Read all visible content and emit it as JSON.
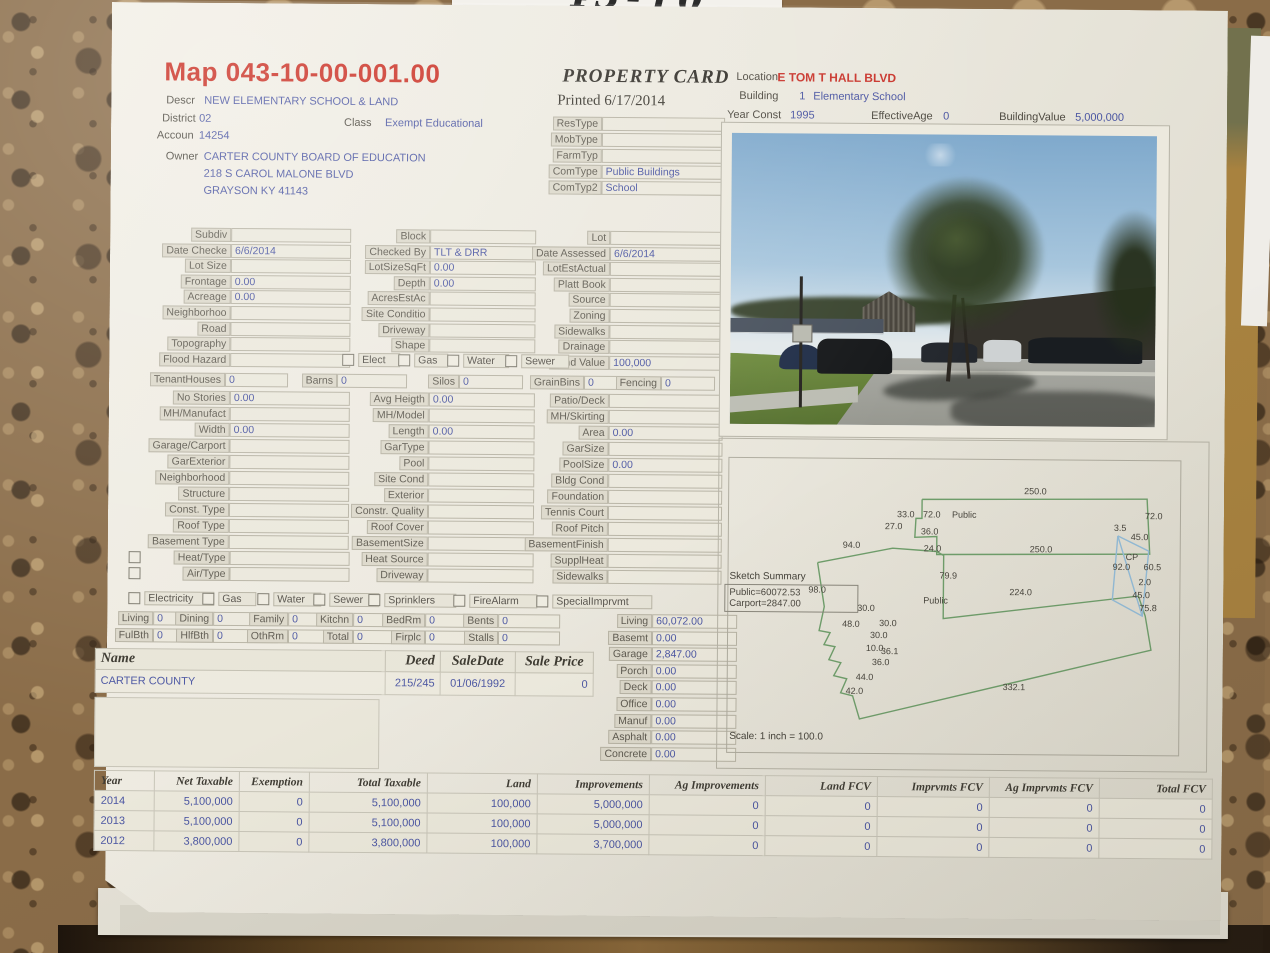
{
  "note": {
    "handwriting": "43-10"
  },
  "header": {
    "map_number": "Map 043-10-00-001.00",
    "card_title": "PROPERTY CARD",
    "printed": "Printed 6/17/2014",
    "descr_label": "Descr",
    "descr": "NEW ELEMENTARY SCHOOL & LAND",
    "district_label": "District",
    "district": "02",
    "class_label": "Class",
    "class_value": "Exempt Educational",
    "accoun_label": "Accoun",
    "accoun": "14254",
    "owner_label": "Owner",
    "owner": "CARTER COUNTY BOARD OF EDUCATION",
    "owner_addr1": "218 S CAROL MALONE BLVD",
    "owner_addr2": "GRAYSON KY 41143",
    "location_label": "Location",
    "location": "E TOM T HALL BLVD",
    "building_label": "Building",
    "building_num": "1",
    "building_name": "Elementary School",
    "year_const_label": "Year Const",
    "year_const": "1995",
    "effective_age_label": "EffectiveAge",
    "effective_age": "0",
    "building_value_label": "BuildingValue",
    "building_value": "5,000,000"
  },
  "type_table": [
    {
      "label": "ResType",
      "value": ""
    },
    {
      "label": "MobType",
      "value": ""
    },
    {
      "label": "FarmTyp",
      "value": ""
    },
    {
      "label": "ComType",
      "value": "Public Buildings"
    },
    {
      "label": "ComTyp2",
      "value": "School"
    }
  ],
  "grid": {
    "colA1": [
      {
        "label": "Subdiv",
        "value": ""
      },
      {
        "label": "Date Checke",
        "value": "6/6/2014"
      },
      {
        "label": "Lot Size",
        "value": ""
      },
      {
        "label": "Frontage",
        "value": "0.00"
      },
      {
        "label": "Acreage",
        "value": "0.00"
      },
      {
        "label": "Neighborhoo",
        "value": ""
      },
      {
        "label": "Road",
        "value": ""
      },
      {
        "label": "Topography",
        "value": ""
      },
      {
        "label": "Flood Hazard",
        "value": ""
      }
    ],
    "colB1": [
      {
        "label": "Block",
        "value": ""
      },
      {
        "label": "Checked By",
        "value": "TLT & DRR"
      },
      {
        "label": "LotSizeSqFt",
        "value": "0.00"
      },
      {
        "label": "Depth",
        "value": "0.00"
      },
      {
        "label": "AcresEstAc",
        "value": ""
      },
      {
        "label": "Site Conditio",
        "value": ""
      },
      {
        "label": "Driveway",
        "value": ""
      },
      {
        "label": "Shape",
        "value": ""
      }
    ],
    "colC1": [
      {
        "label": "Lot",
        "value": ""
      },
      {
        "label": "Date Assessed",
        "value": "6/6/2014"
      },
      {
        "label": "LotEstActual",
        "value": ""
      },
      {
        "label": "Platt Book",
        "value": ""
      },
      {
        "label": "Source",
        "value": ""
      },
      {
        "label": "Zoning",
        "value": ""
      },
      {
        "label": "Sidewalks",
        "value": ""
      },
      {
        "label": "Drainage",
        "value": ""
      },
      {
        "label": "Land Value",
        "value": "100,000"
      }
    ],
    "utilities_inline": [
      "Elect",
      "Gas",
      "Water",
      "Sewer"
    ],
    "farm_row": [
      {
        "label": "TenantHouses",
        "value": "0"
      },
      {
        "label": "Barns",
        "value": "0"
      },
      {
        "label": "Silos",
        "value": "0"
      },
      {
        "label": "GrainBins",
        "value": "0"
      },
      {
        "label": "Fencing",
        "value": "0"
      }
    ],
    "colA2": [
      {
        "label": "No Stories",
        "value": "0.00"
      },
      {
        "label": "MH/Manufact",
        "value": ""
      },
      {
        "label": "Width",
        "value": "0.00"
      },
      {
        "label": "Garage/Carport",
        "value": ""
      },
      {
        "label": "GarExterior",
        "value": ""
      },
      {
        "label": "Neighborhood",
        "value": ""
      },
      {
        "label": "Structure",
        "value": ""
      },
      {
        "label": "Const. Type",
        "value": ""
      },
      {
        "label": "Roof Type",
        "value": ""
      },
      {
        "label": "Basement Type",
        "value": ""
      },
      {
        "label": "Heat/Type",
        "value": "",
        "cb": true
      },
      {
        "label": "Air/Type",
        "value": "",
        "cb": true
      }
    ],
    "colB2": [
      {
        "label": "Avg Heigth",
        "value": "0.00"
      },
      {
        "label": "MH/Model",
        "value": ""
      },
      {
        "label": "Length",
        "value": "0.00"
      },
      {
        "label": "GarType",
        "value": ""
      },
      {
        "label": "Pool",
        "value": ""
      },
      {
        "label": "Site Cond",
        "value": ""
      },
      {
        "label": "Exterior",
        "value": ""
      },
      {
        "label": "Constr. Quality",
        "value": ""
      },
      {
        "label": "Roof Cover",
        "value": ""
      },
      {
        "label": "BasementSize",
        "value": ""
      },
      {
        "label": "Heat Source",
        "value": ""
      },
      {
        "label": "Driveway",
        "value": ""
      }
    ],
    "colC2": [
      {
        "label": "Patio/Deck",
        "value": ""
      },
      {
        "label": "MH/Skirting",
        "value": ""
      },
      {
        "label": "Area",
        "value": "0.00"
      },
      {
        "label": "GarSize",
        "value": ""
      },
      {
        "label": "PoolSize",
        "value": "0.00"
      },
      {
        "label": "Bldg Cond",
        "value": ""
      },
      {
        "label": "Foundation",
        "value": ""
      },
      {
        "label": "Tennis Court",
        "value": ""
      },
      {
        "label": "Roof Pitch",
        "value": ""
      },
      {
        "label": "BasementFinish",
        "value": ""
      },
      {
        "label": "SupplHeat",
        "value": ""
      },
      {
        "label": "Sidewalks",
        "value": ""
      }
    ],
    "services_row": [
      "Electricity",
      "Gas",
      "Water",
      "Sewer",
      "Sprinklers",
      "FireAlarm",
      "SpecialImprvmt"
    ],
    "rooms_row1": [
      {
        "label": "Living",
        "value": "0"
      },
      {
        "label": "Dining",
        "value": "0"
      },
      {
        "label": "Family",
        "value": "0"
      },
      {
        "label": "Kitchn",
        "value": "0"
      },
      {
        "label": "BedRm",
        "value": "0"
      },
      {
        "label": "Bents",
        "value": "0"
      }
    ],
    "rooms_row2": [
      {
        "label": "FulBth",
        "value": "0"
      },
      {
        "label": "HlfBth",
        "value": "0"
      },
      {
        "label": "OthRm",
        "value": "0"
      },
      {
        "label": "Total",
        "value": "0"
      },
      {
        "label": "Firplc",
        "value": "0"
      },
      {
        "label": "Stalls",
        "value": "0"
      }
    ]
  },
  "areas": [
    {
      "label": "Living",
      "value": "60,072.00"
    },
    {
      "label": "Basemt",
      "value": "0.00"
    },
    {
      "label": "Garage",
      "value": "2,847.00"
    },
    {
      "label": "Porch",
      "value": "0.00"
    },
    {
      "label": "Deck",
      "value": "0.00"
    },
    {
      "label": "Office",
      "value": "0.00"
    },
    {
      "label": "Manuf",
      "value": "0.00"
    },
    {
      "label": "Asphalt",
      "value": "0.00"
    },
    {
      "label": "Concrete",
      "value": "0.00"
    }
  ],
  "sales": {
    "headers": [
      "Name",
      "Deed",
      "SaleDate",
      "Sale Price"
    ],
    "rows": [
      [
        "CARTER COUNTY",
        "215/245",
        "01/06/1992",
        "0"
      ]
    ]
  },
  "sketch": {
    "summary_title": "Sketch Summary",
    "summary_lines": [
      "Public=60072.53",
      "Carport=2847.00"
    ],
    "scale": "Scale: 1 inch = 100.0",
    "shapes": [
      {
        "name": "building-outline-upper",
        "stroke": "#6f9e6b",
        "points": "926,493 1151,491 1154,546 941,548 941,530 919,531 920,512 926,512 926,493"
      },
      {
        "name": "building-outline-lower",
        "stroke": "#6f9e6b",
        "points": "822,557 897,542 941,545 948,549 948,612 1143,588 1150,608 1156,642 865,713 858,690 846,687 852,673 839,670 846,657 834,654 840,641 829,639 835,627 824,625 829,601 822,557"
      },
      {
        "name": "carport-outline",
        "stroke": "#93bcd8",
        "points": "1122,528 1153,543 1147,608 1117,592 1122,528"
      },
      {
        "name": "carport-diagonal",
        "stroke": "#93bcd8",
        "points": "1122,528 1147,608"
      }
    ],
    "labels": [
      {
        "text": "250.0",
        "x": 1028,
        "y": 479
      },
      {
        "text": "33.0",
        "x": 901,
        "y": 503
      },
      {
        "text": "72.0",
        "x": 927,
        "y": 503
      },
      {
        "text": "Public",
        "x": 956,
        "y": 503
      },
      {
        "text": "72.0",
        "x": 1149,
        "y": 503
      },
      {
        "text": "27.0",
        "x": 889,
        "y": 515
      },
      {
        "text": "36.0",
        "x": 925,
        "y": 520
      },
      {
        "text": "3.5",
        "x": 1118,
        "y": 515
      },
      {
        "text": "45.0",
        "x": 1135,
        "y": 524
      },
      {
        "text": "94.0",
        "x": 847,
        "y": 534
      },
      {
        "text": "24.0",
        "x": 928,
        "y": 537
      },
      {
        "text": "250.0",
        "x": 1034,
        "y": 537
      },
      {
        "text": "CP",
        "x": 1130,
        "y": 544
      },
      {
        "text": "92.0",
        "x": 1117,
        "y": 554
      },
      {
        "text": "60.5",
        "x": 1148,
        "y": 554
      },
      {
        "text": "79.9",
        "x": 944,
        "y": 564
      },
      {
        "text": "2.0",
        "x": 1143,
        "y": 569
      },
      {
        "text": "98.0",
        "x": 813,
        "y": 579
      },
      {
        "text": "224.0",
        "x": 1014,
        "y": 580
      },
      {
        "text": "45.0",
        "x": 1137,
        "y": 582
      },
      {
        "text": "Public",
        "x": 928,
        "y": 589
      },
      {
        "text": "30.0",
        "x": 862,
        "y": 597
      },
      {
        "text": "75.8",
        "x": 1144,
        "y": 595
      },
      {
        "text": "48.0",
        "x": 847,
        "y": 613
      },
      {
        "text": "30.0",
        "x": 884,
        "y": 612
      },
      {
        "text": "30.0",
        "x": 875,
        "y": 624
      },
      {
        "text": "10.0",
        "x": 871,
        "y": 637
      },
      {
        "text": "36.1",
        "x": 886,
        "y": 640
      },
      {
        "text": "36.0",
        "x": 877,
        "y": 651
      },
      {
        "text": "44.0",
        "x": 861,
        "y": 666
      },
      {
        "text": "42.0",
        "x": 851,
        "y": 680
      },
      {
        "text": "332.1",
        "x": 1008,
        "y": 675
      }
    ]
  },
  "assessment": {
    "headers": [
      "Year",
      "Net Taxable",
      "Exemption",
      "Total Taxable",
      "Land",
      "Improvements",
      "Ag Improvements",
      "Land FCV",
      "Imprvmts FCV",
      "Ag Imprvmts FCV",
      "Total FCV"
    ],
    "rows": [
      [
        "2014",
        "5,100,000",
        "0",
        "5,100,000",
        "100,000",
        "5,000,000",
        "0",
        "0",
        "0",
        "0",
        "0"
      ],
      [
        "2013",
        "5,100,000",
        "0",
        "5,100,000",
        "100,000",
        "5,000,000",
        "0",
        "0",
        "0",
        "0",
        "0"
      ],
      [
        "2012",
        "3,800,000",
        "0",
        "3,800,000",
        "100,000",
        "3,700,000",
        "0",
        "0",
        "0",
        "0",
        "0"
      ]
    ]
  }
}
